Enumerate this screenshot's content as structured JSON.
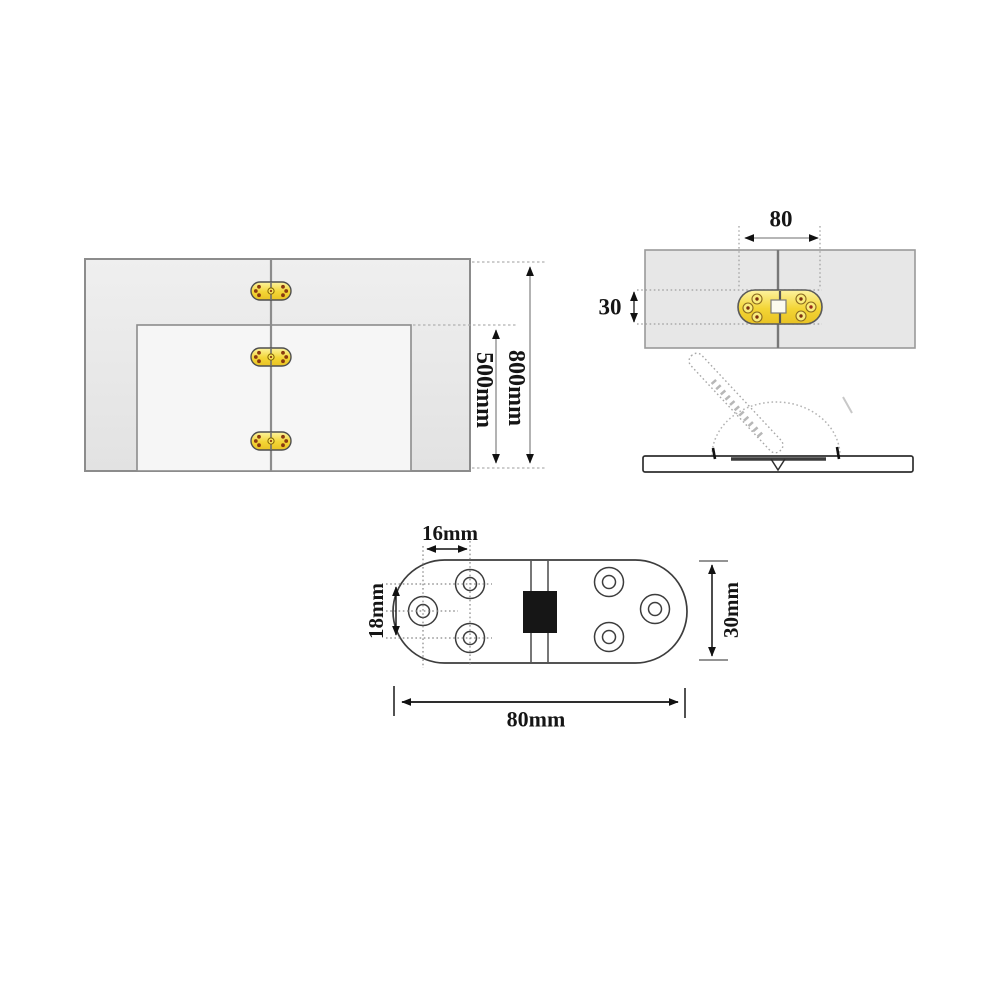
{
  "dimensions": {
    "assembly_view": {
      "overall_height": "800mm",
      "flap_height": "500mm"
    },
    "installed_top_view": {
      "hinge_length": "80",
      "hinge_width": "30"
    },
    "hinge_detail_view": {
      "hole_pitch_horizontal": "16mm",
      "hole_pitch_vertical": "18mm",
      "plate_width": "30mm",
      "plate_length": "80mm"
    }
  },
  "colors": {
    "hinge_brass": "#f0cd2f",
    "panel_fill": "#e9e9e9",
    "outline": "#3d3d3d",
    "dimension_text": "#151515"
  }
}
